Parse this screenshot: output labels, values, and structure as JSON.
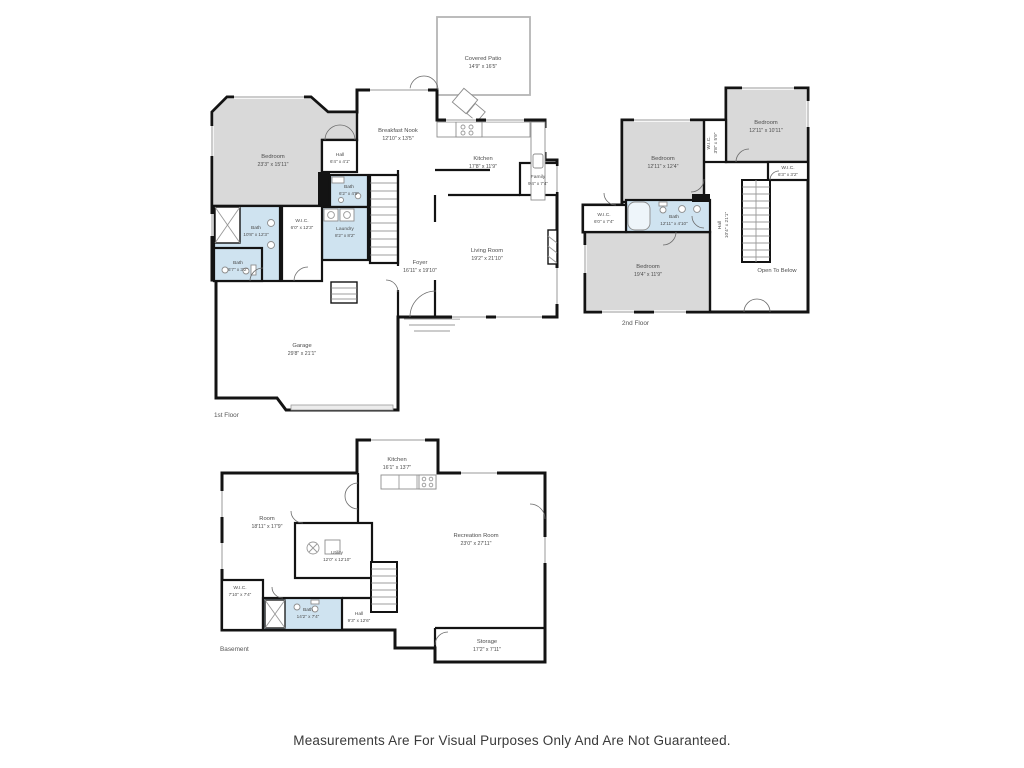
{
  "page": {
    "disclaimer": "Measurements Are For Visual Purposes Only And Are Not Guaranteed."
  },
  "colors": {
    "wall": "#131313",
    "bedroom_fill": "#d9d9d9",
    "bath_fill": "#cfe3f0",
    "background": "#ffffff"
  },
  "floors": [
    {
      "name": "1st Floor",
      "rooms": [
        {
          "label": "Covered Patio",
          "dims": "14'9\" x 16'5\""
        },
        {
          "label": "Breakfast Nook",
          "dims": "12'10\" x 13'5\""
        },
        {
          "label": "Kitchen",
          "dims": "17'8\" x 11'9\""
        },
        {
          "label": "Family",
          "dims": "9'4\" x 7'4\""
        },
        {
          "label": "Bedroom",
          "dims": "23'3\" x 15'11\""
        },
        {
          "label": "Hall",
          "dims": "6'4\" x 4'1\""
        },
        {
          "label": "Bath",
          "dims": "6'2\" x 4'9\""
        },
        {
          "label": "Laundry",
          "dims": "8'2\" x 8'2\""
        },
        {
          "label": "Bath",
          "dims": "10'8\" x 12'3\""
        },
        {
          "label": "W.I.C.",
          "dims": "6'0\" x 12'3\""
        },
        {
          "label": "Bath",
          "dims": "6'7\" x 3'2\""
        },
        {
          "label": "Foyer",
          "dims": "16'11\" x 19'10\""
        },
        {
          "label": "Living Room",
          "dims": "19'2\" x 21'10\""
        },
        {
          "label": "Garage",
          "dims": "29'8\" x 21'1\""
        }
      ]
    },
    {
      "name": "2nd Floor",
      "rooms": [
        {
          "label": "Bedroom",
          "dims": "12'11\" x 12'4\""
        },
        {
          "label": "W.I.C.",
          "dims": "3'8\" x 5'9\""
        },
        {
          "label": "Bedroom",
          "dims": "12'11\" x 10'11\""
        },
        {
          "label": "W.I.C.",
          "dims": "6'3\" x 3'2\""
        },
        {
          "label": "Bath",
          "dims": "12'11\" x 4'10\""
        },
        {
          "label": "W.I.C.",
          "dims": "6'0\" x 7'4\""
        },
        {
          "label": "Bedroom",
          "dims": "19'4\" x 11'9\""
        },
        {
          "label": "Hall",
          "dims": "10'4\" x 21'1\""
        },
        {
          "label": "Open To Below",
          "dims": ""
        }
      ]
    },
    {
      "name": "Basement",
      "rooms": [
        {
          "label": "Kitchen",
          "dims": "16'1\" x 13'7\""
        },
        {
          "label": "Room",
          "dims": "18'11\" x 17'9\""
        },
        {
          "label": "Utility",
          "dims": "12'0\" x 12'10\""
        },
        {
          "label": "Recreation Room",
          "dims": "23'0\" x 27'11\""
        },
        {
          "label": "W.I.C.",
          "dims": "7'10\" x 7'4\""
        },
        {
          "label": "Bath",
          "dims": "14'2\" x 7'4\""
        },
        {
          "label": "Hall",
          "dims": "9'3\" x 12'6\""
        },
        {
          "label": "Storage",
          "dims": "17'2\" x 7'11\""
        }
      ]
    }
  ]
}
